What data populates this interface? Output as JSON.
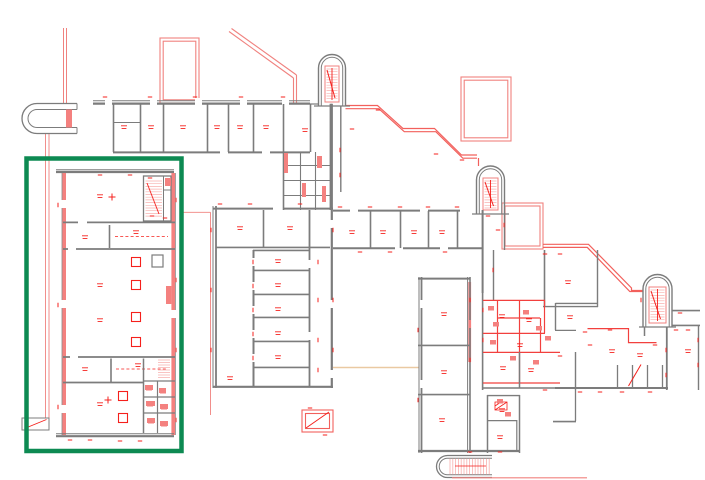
{
  "document": {
    "type": "architectural floor plan (CAD linework)",
    "description": "Multi-wing building floor plan drawn in red and grey linework on a white background. The wings step diagonally from the upper left down to the lower right; three round-topped stair towers sit along the stepped red outline, a rounded canopy structure is at the upper left, and dense tiny red dimension / room-number annotations cover the walls. A thick green rectangle highlights the left wing of the building.",
    "background_color": "#ffffff"
  },
  "colors": {
    "wall_grey": "#7c7c7c",
    "annotation_red": "#f5201c",
    "interior_wall_red": "#f2403e",
    "step_outline_red": "#f2605c",
    "wall_fill_salmon": "#f4817f",
    "light_pink_line": "#f8b0ae",
    "utility_line_tan": "#eac9a2",
    "highlight_green": "#0d8a52",
    "background": "#ffffff"
  },
  "highlight": {
    "label": "selected wing highlight box",
    "color": "#0d8a52"
  },
  "annotations": {
    "room_labels_style": "tiny red tags (illegible at this scale)",
    "stair_towers": 3
  }
}
